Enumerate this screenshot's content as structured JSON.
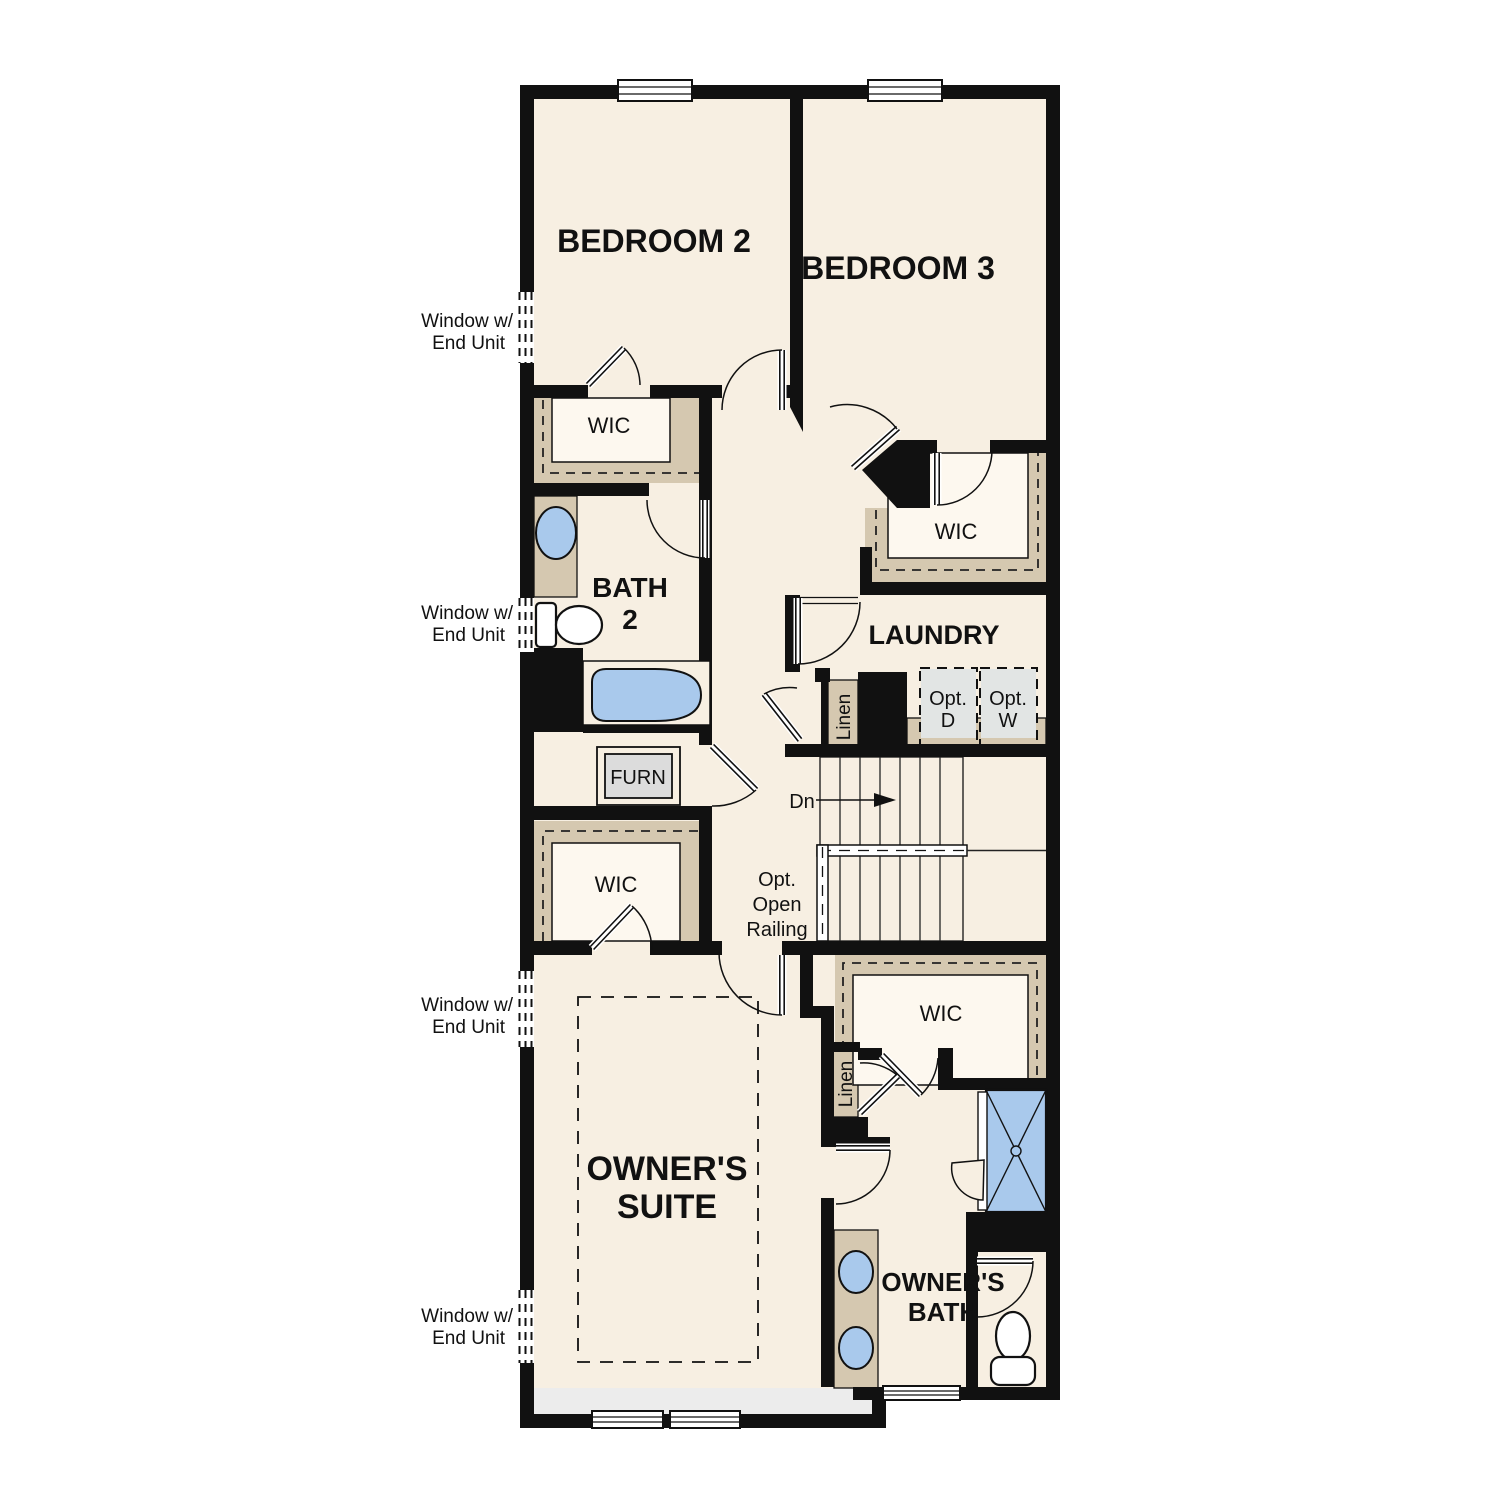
{
  "colors": {
    "wall": "#111111",
    "floor": "#f7efe2",
    "closet_interior": "#fdf8ef",
    "shelf_tan": "#d5c8b0",
    "fixture_blue": "#a9c9ec",
    "optional_gray": "#e2e5e4",
    "deck_gray": "#ececec"
  },
  "rooms": {
    "bedroom2": "BEDROOM 2",
    "bedroom3": "BEDROOM 3",
    "bath2_line1": "BATH",
    "bath2_line2": "2",
    "laundry": "LAUNDRY",
    "owners_suite_line1": "OWNER'S",
    "owners_suite_line2": "SUITE",
    "owners_bath_line1": "OWNER'S",
    "owners_bath_line2": "BATH"
  },
  "closets": {
    "wic": "WIC",
    "linen": "Linen"
  },
  "labels": {
    "furnace": "FURN",
    "opt_dryer_line1": "Opt.",
    "opt_dryer_line2": "D",
    "opt_washer_line1": "Opt.",
    "opt_washer_line2": "W",
    "stairs_down": "Dn",
    "opt_railing_line1": "Opt.",
    "opt_railing_line2": "Open",
    "opt_railing_line3": "Railing",
    "window_note_line1": "Window w/",
    "window_note_line2": "End Unit"
  }
}
